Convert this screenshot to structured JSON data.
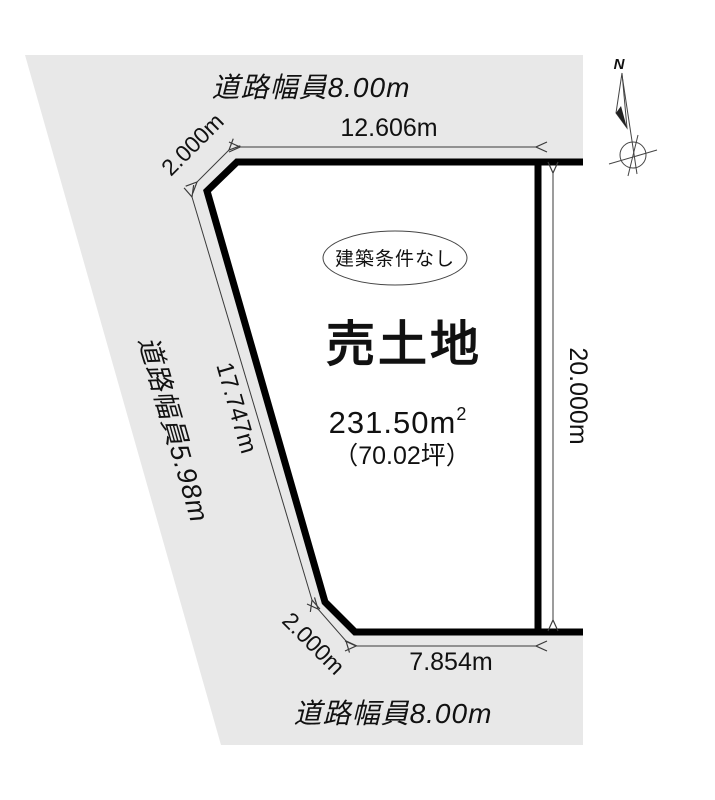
{
  "colors": {
    "road_fill": "#e8e8e8",
    "plot_fill": "#ffffff",
    "outline": "#000000"
  },
  "roads": {
    "top": {
      "label": "道路幅員8.00m"
    },
    "left": {
      "label": "道路幅員5.98m"
    },
    "bottom": {
      "label": "道路幅員8.00m"
    }
  },
  "dimensions": {
    "top": "12.606m",
    "top_left_cut": "2.000m",
    "left": "17.747m",
    "right": "20.000m",
    "bottom": "7.854m",
    "bottom_left_cut": "2.000m"
  },
  "parcel": {
    "badge": "建築条件なし",
    "title": "売土地",
    "area_value": "231.50m",
    "area_sup": "2",
    "area_tsubo": "（70.02坪）"
  },
  "compass": {
    "label": "N"
  }
}
